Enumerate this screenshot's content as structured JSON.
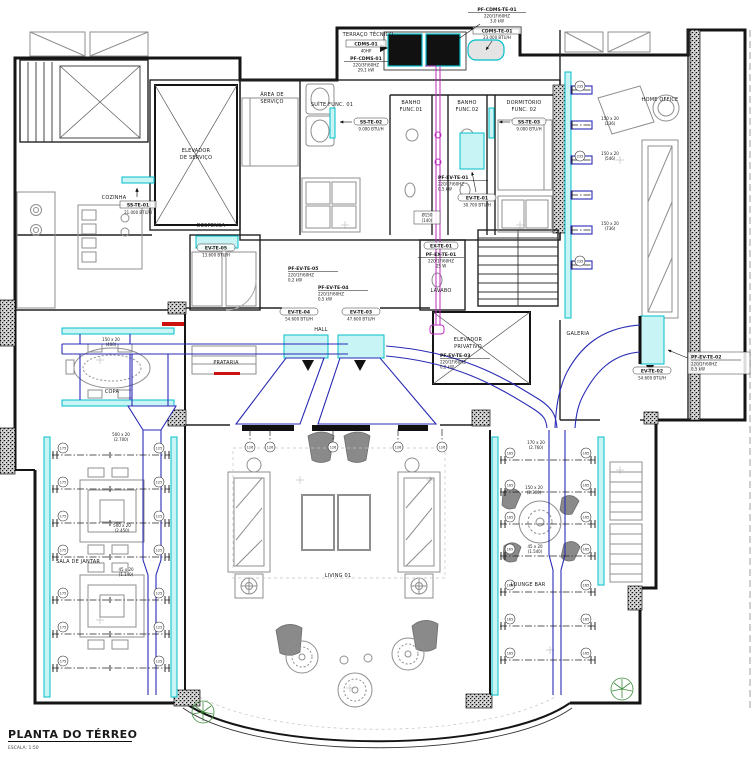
{
  "title_block": {
    "title": "PLANTA DO TÉRREO",
    "scale": "ESCALA: 1:50"
  },
  "colors": {
    "paper": "#ffffff",
    "ink": "#1a1a1a",
    "wall": "#151515",
    "furniture": "#8f8f8f",
    "diffuser": "#00bfc8",
    "diffuser_fill": "#c8f4f6",
    "duct": "#2a2ab4",
    "refrigerant": "#bb2dbb",
    "alert": "#cc1111",
    "plant": "#3d8c3d",
    "grid": "#c9c9c9"
  },
  "rooms": {
    "terraco_tecnico": "TERRAÇO TÉCNICO",
    "area_servico": [
      "ÁREA DE",
      "SERVIÇO"
    ],
    "elevador_servico": [
      "ELEVADOR",
      "DE SERVIÇO"
    ],
    "cozinha": "COZINHA",
    "despensa": "DESPENSA",
    "suite_func_01": "SUÍTE FUNC. 01",
    "banho_func_01": [
      "BANHO",
      "FUNC.01"
    ],
    "banho_func_02": [
      "BANHO",
      "FUNC.02"
    ],
    "dormitorio_func_02": [
      "DORMITÓRIO",
      "FUNC. 02"
    ],
    "home_office": "HOME OFFICE",
    "lavabo": "LAVABO",
    "hall": "HALL",
    "elevador_privativo": [
      "ELEVADOR",
      "PRIVATIVO"
    ],
    "galeria": "GALERIA",
    "prataria": "PRATARIA",
    "copa": "COPA",
    "sala_de_jantar": "SALA DE JANTAR",
    "living_01": "LIVING 01",
    "lounge_bar": "LOUNGE BAR"
  },
  "equipment": {
    "pf_cdms_te_01": {
      "name": "PF-CDMS-TE-01",
      "elec": "220/1F/60HZ",
      "power": "3,0 kW"
    },
    "cdms_te_01": {
      "name": "CDMS-TE-01",
      "capacity": "23.000 BTU/H"
    },
    "cdms_01": {
      "name": "CDMS-01",
      "power": "40HP"
    },
    "pf_cdms_01": {
      "name": "PF-CDMS-01",
      "elec": "220/3F/60HZ",
      "power": "29,1 kW"
    },
    "ss_te_01": {
      "name": "SS-TE-01",
      "capacity": "21.000 BTU/H"
    },
    "ss_te_02": {
      "name": "SS-TE-02",
      "capacity": "9.000 BTU/H"
    },
    "ss_te_03": {
      "name": "SS-TE-03",
      "capacity": "9.000 BTU/H"
    },
    "ev_te_01": {
      "name": "EV-TE-01",
      "capacity": "30.700 BTU/H"
    },
    "pf_ev_te_01": {
      "name": "PF-EV-TE-01",
      "elec": "220/1F/60HZ",
      "power": "0,5 kW"
    },
    "ev_te_02": {
      "name": "EV-TE-02",
      "capacity": "54.600 BTU/H"
    },
    "pf_ev_te_02": {
      "name": "PF-EV-TE-02",
      "elec": "220/1F/60HZ",
      "power": "0,5 kW"
    },
    "ev_te_03": {
      "name": "EV-TE-03",
      "capacity": "47.600 BTU/H"
    },
    "pf_ev_te_03": {
      "name": "PF-EV-TE-03",
      "elec": "220/1F/60HZ",
      "power": "0,2 kW"
    },
    "ev_te_04": {
      "name": "EV-TE-04",
      "capacity": "54.600 BTU/H"
    },
    "pf_ev_te_04": {
      "name": "PF-EV-TE-04",
      "elec": "220/1F/60HZ",
      "power": "0,5 kW"
    },
    "ev_te_05": {
      "name": "EV-TE-05",
      "capacity": "13.600 BTU/H"
    },
    "pf_ev_te_05": {
      "name": "PF-EV-TE-05",
      "elec": "220/1F/60HZ",
      "power": "0,2 kW"
    },
    "ex_te_01": {
      "name": "EX-TE-01"
    },
    "pf_ex_te_01": {
      "name": "PF-EX-TE-01",
      "elec": "220/1F/60HZ",
      "power": "25 W"
    }
  },
  "duct_labels": {
    "copa": {
      "size": "150 x 20",
      "flow": "(400)"
    },
    "dining_1": {
      "size": "500 x 20",
      "flow": "(2.700)"
    },
    "dining_2": {
      "size": "500 x 20",
      "flow": "(2.450)"
    },
    "dining_3": {
      "size": "45 x 20",
      "flow": "(1.140)"
    },
    "lounge_1": {
      "size": "170 x 20",
      "flow": "(2.760)"
    },
    "lounge_2": {
      "size": "150 x 20",
      "flow": "(2.300)"
    },
    "lounge_3": {
      "size": "45 x 20",
      "flow": "(1.540)"
    },
    "office_1": {
      "size": "150 x 20",
      "flow": "(236)"
    },
    "office_2": {
      "size": "150 x 20",
      "flow": "(546)"
    },
    "office_3": {
      "size": "150 x 20",
      "flow": "(736)"
    },
    "exhaust": {
      "size": "Ø150",
      "flow": "(140)"
    }
  },
  "tags": {
    "dining_left": "175",
    "dining_right": "125",
    "lounge_left": "165",
    "lounge_right": "165",
    "living": "126",
    "office": "235"
  }
}
